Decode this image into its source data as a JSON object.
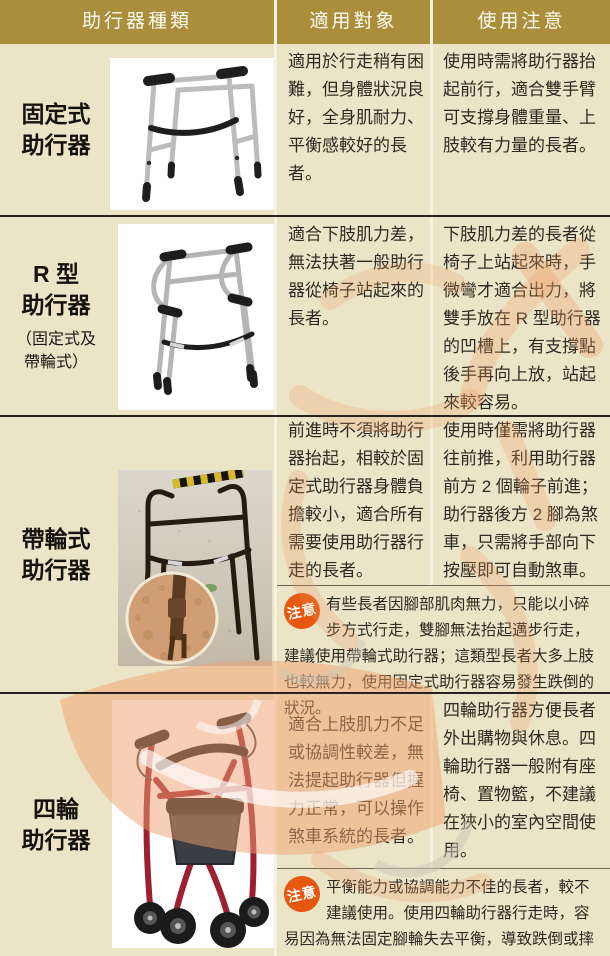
{
  "header": {
    "type_col": "助行器種類",
    "target_col": "適用對象",
    "notes_col": "使用注意"
  },
  "caution_label": "注意",
  "rows": [
    {
      "type": "固定式\n助行器",
      "subtype": "",
      "image": "fixed-walker",
      "target": "適用於行走稍有困難，但身體狀況良好，全身肌耐力、平衡感較好的長者。",
      "notes": "使用時需將助行器抬起前行，適合雙手臂可支撐身體重量、上肢較有力量的長者。"
    },
    {
      "type": "R 型\n助行器",
      "subtype": "（固定式及\n帶輪式）",
      "image": "r-type-walker",
      "target": "適合下肢肌力差，無法扶著一般助行器從椅子站起來的長者。",
      "notes": "下肢肌力差的長者從椅子上站起來時，手微彎才適合出力，將雙手放在 R 型助行器的凹槽上，有支撐點後手再向上放，站起來較容易。"
    },
    {
      "type": "帶輪式\n助行器",
      "subtype": "",
      "image": "wheeled-walker-photo",
      "target": "前進時不須將助行器抬起，相較於固定式助行器身體負擔較小，適合所有需要使用助行器行走的長者。",
      "notes": "使用時僅需將助行器往前推，利用助行器前方 2 個輪子前進；助行器後方 2 腳為煞車，只需將手部向下按壓即可自動煞車。",
      "caution": "有些長者因腳部肌肉無力，只能以小碎步方式行走，雙腳無法抬起邁步行走，建議使用帶輪式助行器；這類型長者大多上肢也較無力，使用固定式助行器容易發生跌倒的狀況。"
    },
    {
      "type": "四輪\n助行器",
      "subtype": "",
      "image": "four-wheel-rollator",
      "target": "適合上肢肌力不足或協調性較差，無法提起助行器但握力正常，可以操作煞車系統的長者。",
      "notes": "四輪助行器方便長者外出購物與休息。四輪助行器一般附有座椅、置物籃，不建議在狹小的室內空間使用。",
      "caution": "平衡能力或協調能力不佳的長者，較不建議使用。使用四輪助行器行走時，容易因為無法固定腳輪失去平衡，導致跌倒或摔傷。"
    }
  ],
  "colors": {
    "header_bg": "#ab8e3c",
    "cell_bg": "#ece4c7",
    "row_divider": "#26231c",
    "caution_badge": "#e8570e",
    "watermark": "#ef9a63",
    "text": "#2e2a21"
  }
}
